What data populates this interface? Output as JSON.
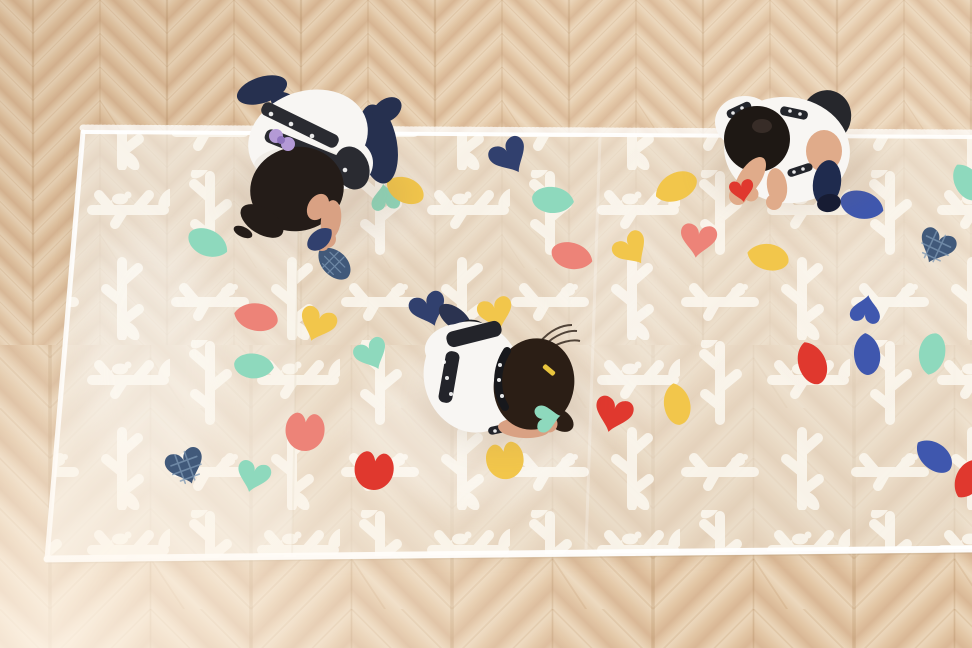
{
  "scene": {
    "title": "Children decorating a sheer branch-print play mat",
    "description": "Top-down view of three preschool children kneeling on a long translucent white mat printed with white branches, leaves and birds, placing colorful fabric petals on it; light chevron parquet wood floor around the mat.",
    "floor": {
      "type": "chevron parquet",
      "light": "#ecd8bd",
      "base": "#e2c5a3",
      "dark": "#d9b795",
      "mid": "#e4c9a9",
      "seam": "#a97f52",
      "joint": "#b98c5f"
    },
    "mat": {
      "fabric": "sheer white organza",
      "pattern": "white branches, twigs, leaves and small birds",
      "ink": "#fcf8f0",
      "base_tint": "#f6efe5",
      "hem": "#ffffff"
    },
    "petal_colors": {
      "coral": "#ed8378",
      "red": "#e0382e",
      "mint": "#8ed9bd",
      "yellow": "#f2c64b",
      "blue": "#3f57ae",
      "navy": "#31406e",
      "navygrid": "#41597a"
    },
    "petals": [
      {
        "shape": "leaf",
        "color": "coral",
        "x": 266,
        "y": 212,
        "r": -30,
        "s": 1.1
      },
      {
        "shape": "leaf",
        "color": "mint",
        "x": 208,
        "y": 243,
        "r": 205,
        "s": 1
      },
      {
        "shape": "fishtail",
        "color": "mint",
        "x": 385,
        "y": 197,
        "r": -8,
        "s": 0.95
      },
      {
        "shape": "leaf",
        "color": "yellow",
        "x": 405,
        "y": 190,
        "r": 25,
        "s": 0.95
      },
      {
        "shape": "leaf",
        "color": "navygrid",
        "x": 334,
        "y": 263,
        "r": 45,
        "s": 0.95
      },
      {
        "shape": "heart",
        "color": "navy",
        "x": 510,
        "y": 157,
        "r": -30,
        "s": 1.25
      },
      {
        "shape": "leaf",
        "color": "mint",
        "x": 553,
        "y": 200,
        "r": 185,
        "s": 1
      },
      {
        "shape": "leaf",
        "color": "yellow",
        "x": 676,
        "y": 187,
        "r": -25,
        "s": 1.05
      },
      {
        "shape": "leaf",
        "color": "blue",
        "x": 862,
        "y": 205,
        "r": 195,
        "s": 1.05
      },
      {
        "shape": "heart",
        "color": "navygrid",
        "x": 936,
        "y": 247,
        "r": 25,
        "s": 1.2
      },
      {
        "shape": "leaf",
        "color": "coral",
        "x": 572,
        "y": 256,
        "r": 195,
        "s": 1
      },
      {
        "shape": "heart",
        "color": "yellow",
        "x": 632,
        "y": 250,
        "r": -35,
        "s": 1.15
      },
      {
        "shape": "heart",
        "color": "coral",
        "x": 698,
        "y": 241,
        "r": 8,
        "s": 1.2
      },
      {
        "shape": "leaf",
        "color": "yellow",
        "x": 768,
        "y": 257,
        "r": 12,
        "s": 1
      },
      {
        "shape": "fishtail",
        "color": "blue",
        "x": 866,
        "y": 309,
        "r": 10,
        "s": 1
      },
      {
        "shape": "leaf",
        "color": "blue",
        "x": 867,
        "y": 354,
        "r": 85,
        "s": 1
      },
      {
        "shape": "leaf",
        "color": "red",
        "x": 812,
        "y": 363,
        "r": 70,
        "s": 1.05
      },
      {
        "shape": "leaf",
        "color": "mint",
        "x": 932,
        "y": 354,
        "r": -80,
        "s": 1
      },
      {
        "shape": "leaf",
        "color": "blue",
        "x": 934,
        "y": 456,
        "r": 40,
        "s": 1
      },
      {
        "shape": "leaf",
        "color": "red",
        "x": 969,
        "y": 479,
        "r": -60,
        "s": 1
      },
      {
        "shape": "leaf",
        "color": "mint",
        "x": 967,
        "y": 182,
        "r": 60,
        "s": 0.95
      },
      {
        "shape": "leaf",
        "color": "coral",
        "x": 256,
        "y": 317,
        "r": 10,
        "s": 1.05
      },
      {
        "shape": "heart",
        "color": "yellow",
        "x": 317,
        "y": 325,
        "r": 20,
        "s": 1.2
      },
      {
        "shape": "heart",
        "color": "mint",
        "x": 372,
        "y": 355,
        "r": -25,
        "s": 1.1
      },
      {
        "shape": "leaf",
        "color": "mint",
        "x": 254,
        "y": 366,
        "r": 185,
        "s": 0.95
      },
      {
        "shape": "heart",
        "color": "navygrid",
        "x": 186,
        "y": 467,
        "r": -20,
        "s": 1.25
      },
      {
        "shape": "heart",
        "color": "mint",
        "x": 253,
        "y": 477,
        "r": 15,
        "s": 1.1
      },
      {
        "shape": "tulip",
        "color": "coral",
        "x": 305,
        "y": 431,
        "r": 5,
        "s": 1.25
      },
      {
        "shape": "tulip",
        "color": "red",
        "x": 374,
        "y": 470,
        "r": 8,
        "s": 1.25
      },
      {
        "shape": "tulip",
        "color": "yellow",
        "x": 505,
        "y": 460,
        "r": -10,
        "s": 1.2
      },
      {
        "shape": "heart",
        "color": "red",
        "x": 613,
        "y": 415,
        "r": 15,
        "s": 1.25
      },
      {
        "shape": "leaf",
        "color": "yellow",
        "x": 677,
        "y": 404,
        "r": 80,
        "s": 1
      },
      {
        "shape": "heart",
        "color": "navy",
        "x": 429,
        "y": 310,
        "r": -20,
        "s": 1.2
      },
      {
        "shape": "heart",
        "color": "yellow",
        "x": 496,
        "y": 314,
        "r": -15,
        "s": 1.15
      },
      {
        "shape": "fishtail",
        "color": "red",
        "x": 742,
        "y": 191,
        "r": 170,
        "s": 0.8,
        "above": true
      },
      {
        "shape": "fishtail",
        "color": "mint",
        "x": 548,
        "y": 418,
        "r": 80,
        "s": 0.9,
        "above": true
      },
      {
        "shape": "leaf",
        "color": "navy",
        "x": 320,
        "y": 239,
        "r": 140,
        "s": 0.7,
        "above": true
      }
    ],
    "children": [
      {
        "id": "child-top-left",
        "label": "girl kneeling at top left placing a navy petal",
        "x": 312,
        "y": 160,
        "hair": "#241c18",
        "shirt": "#f8f6f3",
        "shade": "#e6dfd6",
        "strap": "#2a2b31",
        "legwear": "#26304f",
        "skin": "#d9a183",
        "accent": "#b49ad6",
        "accent_dark": "#8f74bd",
        "accessory": "lavender scrunchie"
      },
      {
        "id": "child-top-right",
        "label": "boy crouching at top right holding a red petal",
        "x": 788,
        "y": 152,
        "hair": "#1e1814",
        "hair_shine": "#473a33",
        "shirt": "#f8f6f3",
        "trim": "#23252b",
        "shorts": "#26272c",
        "legwear": "#1f2b4e",
        "sock_dark": "#171c33",
        "skin": "#e0ab8a"
      },
      {
        "id": "child-center",
        "label": "girl leaning forward at center placing a mint petal",
        "x": 500,
        "y": 390,
        "hair": "#2b1e15",
        "shirt": "#f8f6f3",
        "strap": "#23242a",
        "legwear": "#2b3350",
        "foot_dark": "#1c1d22",
        "skin": "#d9a183",
        "clip": "#e9c53e",
        "accessory": "yellow hair clip and dotted headband"
      }
    ]
  }
}
